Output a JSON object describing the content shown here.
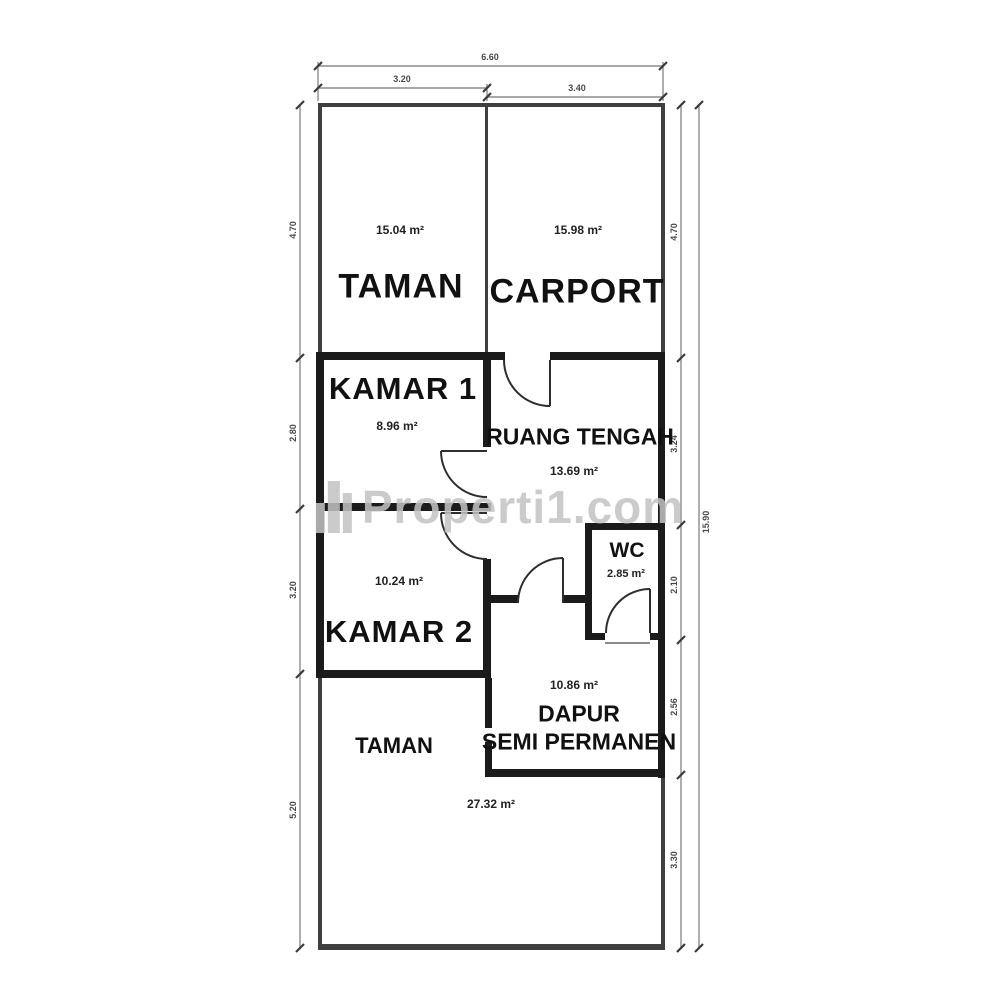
{
  "watermark": {
    "text": "Properti1.com",
    "icon": "building-skyline-icon"
  },
  "plan": {
    "rooms": {
      "taman_top": {
        "name": "TAMAN",
        "area": "15.04 m²"
      },
      "carport": {
        "name": "CARPORT",
        "area": "15.98 m²"
      },
      "kamar1": {
        "name": "KAMAR 1",
        "area": "8.96 m²"
      },
      "ruang_tengah": {
        "name": "RUANG TENGAH",
        "area": "13.69 m²"
      },
      "kamar2": {
        "name": "KAMAR 2",
        "area": "10.24 m²"
      },
      "wc": {
        "name": "WC",
        "area": "2.85 m²"
      },
      "dapur": {
        "name": "DAPUR",
        "name2": "SEMI PERMANEN",
        "area": "10.86 m²"
      },
      "taman_bottom": {
        "name": "TAMAN",
        "area": "27.32 m²"
      }
    },
    "dimensions": {
      "top_total": "6.60",
      "top_left": "3.20",
      "top_right": "3.40",
      "left": [
        "4.70",
        "2.80",
        "3.20",
        "5.20"
      ],
      "right": [
        "4.70",
        "3.24",
        "2.10",
        "2.56",
        "3.30"
      ],
      "right_total": "15.90"
    },
    "colors": {
      "wall": "#1b1b1b",
      "wall_light": "#3f3f3f",
      "dim_line": "#8c8c8c",
      "watermark": "#c3c3c3"
    }
  }
}
